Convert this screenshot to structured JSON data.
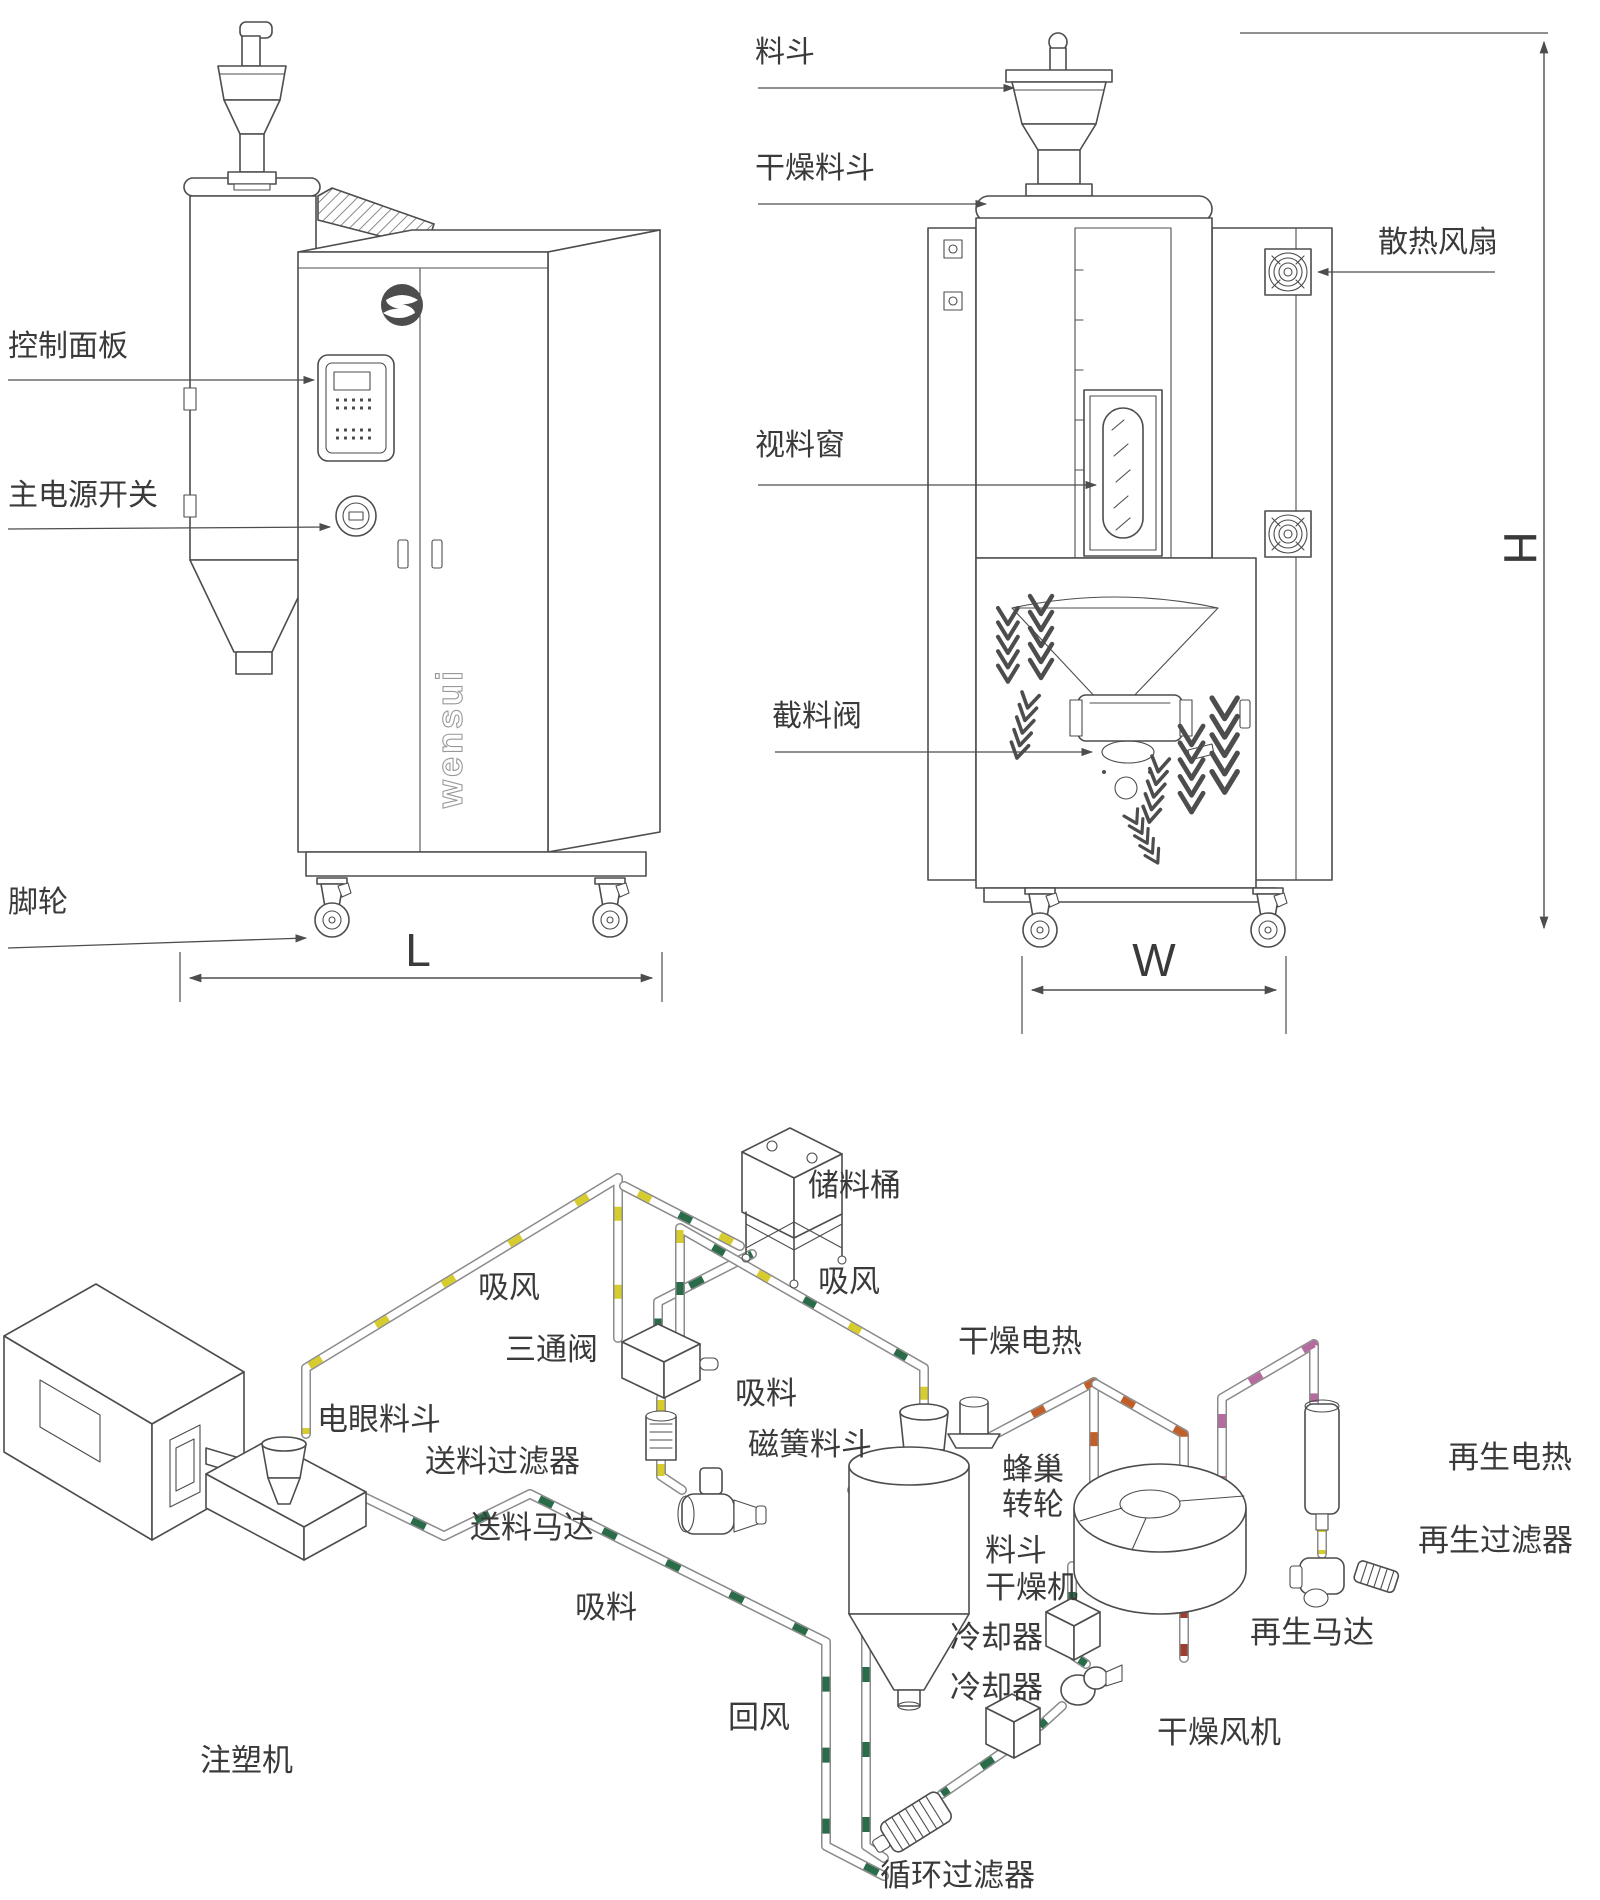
{
  "front_view": {
    "labels": {
      "control_panel": "控制面板",
      "main_power_switch": "主电源开关",
      "caster": "脚轮",
      "length_dim": "L"
    },
    "logo_text": "wensui"
  },
  "rear_view": {
    "labels": {
      "hopper": "料斗",
      "drying_hopper": "干燥料斗",
      "cooling_fan": "散热风扇",
      "viewing_window": "视料窗",
      "cutoff_valve": "截料阀",
      "width_dim": "W",
      "height_dim": "H"
    }
  },
  "flow_diagram": {
    "labels": {
      "storage_barrel": "储料桶",
      "suction_air_left": "吸风",
      "suction_air_right": "吸风",
      "three_way_valve": "三通阀",
      "suction_material_upper": "吸料",
      "suction_material_lower": "吸料",
      "drying_heater": "干燥电热",
      "photo_eye_hopper": "电眼料斗",
      "feed_filter": "送料过滤器",
      "feed_motor": "送料马达",
      "magnetic_hopper": "磁簧料斗",
      "honeycomb_wheel_line1": "蜂巢",
      "honeycomb_wheel_line2": "转轮",
      "hopper_dryer_line1": "料斗",
      "hopper_dryer_line2": "干燥机",
      "regen_heater": "再生电热",
      "regen_filter": "再生过滤器",
      "regen_motor": "再生马达",
      "cooler_1": "冷却器",
      "cooler_2": "冷却器",
      "drying_blower": "干燥风机",
      "return_air": "回风",
      "injection_molding_machine": "注塑机",
      "circulation_filter": "循环过滤器"
    },
    "pipe_colors": {
      "suction_air": "#d6cc2d",
      "material": "#2a6b4a",
      "hot_air": "#c05f2a",
      "exhaust": "#9b4030",
      "regen_air": "#b66b9e"
    }
  },
  "line_color": "#4d4d4d"
}
